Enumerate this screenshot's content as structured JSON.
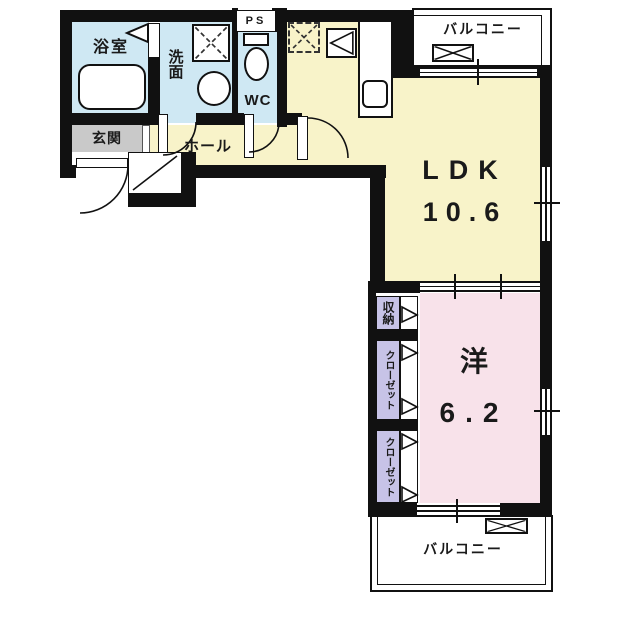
{
  "plan_title": "apartment-floor-plan",
  "colors": {
    "wall": "#111111",
    "ldk": "#f8f3c9",
    "wet": "#cfe8f3",
    "bedroom": "#f8e2ea",
    "closet": "#c7c3e7",
    "entrance": "#c9c9c9",
    "line": "#111111",
    "bg": "#ffffff"
  },
  "rooms": {
    "bath": {
      "label": "浴室"
    },
    "washroom": {
      "label": "洗面"
    },
    "wc": {
      "label": "WC"
    },
    "ps": {
      "label": "PS"
    },
    "entrance": {
      "label": "玄関"
    },
    "hall": {
      "label": "ホール"
    },
    "ldk": {
      "label": "LDK",
      "area": "10.6"
    },
    "bedroom": {
      "label": "洋",
      "area": "6.2"
    },
    "storage": {
      "label": "収納"
    },
    "closet_upper": {
      "label": "クローゼット"
    },
    "closet_lower": {
      "label": "クローゼット"
    },
    "balcony_top": {
      "label": "バルコニー"
    },
    "balcony_bottom": {
      "label": "バルコニー"
    }
  },
  "symbols": {
    "placement_x_box": "✕",
    "closet_folding_door": "▷",
    "bath_door": "◁",
    "bathtub": "rounded-rect",
    "wash_basin": "circle",
    "toilet": "tank+bowl",
    "kitchen_sink": "rounded-square",
    "door_swing": "quarter-arc",
    "sliding_window": "double-line"
  }
}
